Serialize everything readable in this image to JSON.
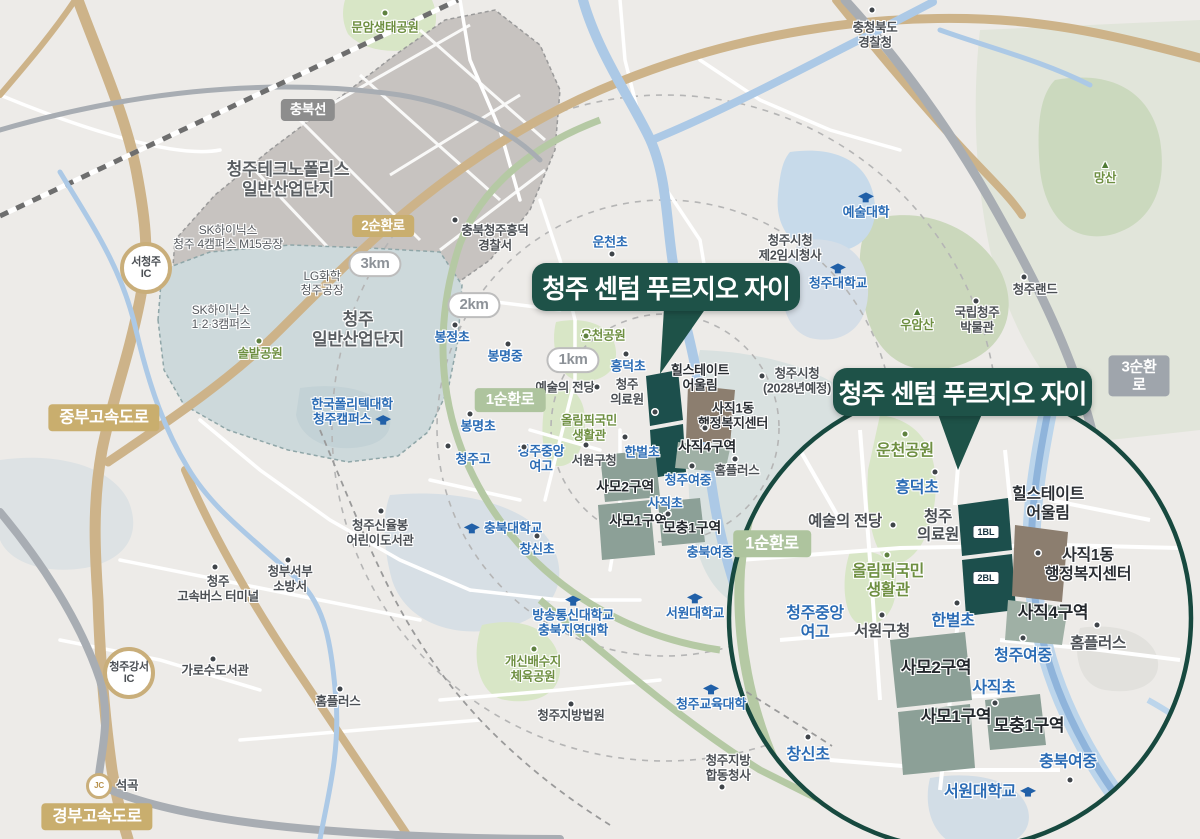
{
  "title": "청주 센텀 푸르지오 자이",
  "colors": {
    "accent_teal": "#1E5248",
    "site_teal": "#1C4F4C",
    "hillstate_brown": "#8C7E6F",
    "district_sage": "#8CA097",
    "school_blue": "#2B6CB5",
    "park_green": "#6E8F41",
    "highway_tan": "#C9AE6E",
    "ring_road_green": "#AEC49E",
    "expressway_gray": "#9FA5AC",
    "river_blue": "#ACC9E6"
  },
  "inset": {
    "bl1": "1BL",
    "bl2": "2BL",
    "labels": [
      {
        "t": "운천공원",
        "x": 905,
        "y": 452,
        "c": "lb-park-lg"
      },
      {
        "t": "흥덕초",
        "x": 917,
        "y": 489,
        "c": "lb-school-lg"
      },
      {
        "t": "예술의 전당",
        "x": 845,
        "y": 522,
        "c": "lb-place-ins"
      },
      {
        "t": "청주\n의료원",
        "x": 938,
        "y": 527,
        "c": "lb-place-ins"
      },
      {
        "t": "힐스테이트\n어울림",
        "x": 1048,
        "y": 505,
        "c": "lb-dark-lg"
      },
      {
        "t": "사직1동\n행정복지센터",
        "x": 1088,
        "y": 566,
        "c": "lb-dark-lg"
      },
      {
        "t": "1순환로",
        "x": 772,
        "y": 544,
        "c": "badge-green-lg",
        "n": "road-badge-1st-ring-inset"
      },
      {
        "t": "올림픽국민\n생활관",
        "x": 888,
        "y": 582,
        "c": "lb-park-lg"
      },
      {
        "t": "청주중앙\n여고",
        "x": 815,
        "y": 624,
        "c": "lb-school-lg"
      },
      {
        "t": "서원구청",
        "x": 882,
        "y": 632,
        "c": "lb-place-ins"
      },
      {
        "t": "한벌초",
        "x": 953,
        "y": 622,
        "c": "lb-school-lg"
      },
      {
        "t": "사직4구역",
        "x": 1053,
        "y": 613,
        "c": "lb-district-lg"
      },
      {
        "t": "홈플러스",
        "x": 1098,
        "y": 644,
        "c": "lb-place-ins"
      },
      {
        "t": "사모2구역",
        "x": 936,
        "y": 668,
        "c": "lb-district-lg"
      },
      {
        "t": "청주여중",
        "x": 1023,
        "y": 657,
        "c": "lb-school-lg"
      },
      {
        "t": "사직초",
        "x": 994,
        "y": 689,
        "c": "lb-school-lg"
      },
      {
        "t": "사모1구역",
        "x": 956,
        "y": 717,
        "c": "lb-district-lg"
      },
      {
        "t": "모충1구역",
        "x": 1029,
        "y": 726,
        "c": "lb-district-lg"
      },
      {
        "t": "창신초",
        "x": 808,
        "y": 756,
        "c": "lb-school-lg"
      },
      {
        "t": "충북여중",
        "x": 1068,
        "y": 763,
        "c": "lb-school-lg"
      },
      {
        "t": "서원대학교",
        "x": 990,
        "y": 793,
        "c": "lb-school-lg",
        "i": "cap",
        "ip": "right"
      }
    ],
    "dots": [
      {
        "x": 905,
        "y": 434,
        "c": "g"
      },
      {
        "x": 935,
        "y": 472
      },
      {
        "x": 893,
        "y": 525
      },
      {
        "x": 887,
        "y": 555,
        "c": "g"
      },
      {
        "x": 882,
        "y": 615
      },
      {
        "x": 957,
        "y": 603
      },
      {
        "x": 1038,
        "y": 553
      },
      {
        "x": 1097,
        "y": 625
      },
      {
        "x": 1023,
        "y": 638
      },
      {
        "x": 995,
        "y": 703
      },
      {
        "x": 808,
        "y": 737
      },
      {
        "x": 1070,
        "y": 780
      }
    ]
  },
  "main_map": {
    "labels": [
      {
        "t": "문암생태공원",
        "x": 385,
        "y": 28,
        "c": "lb-park"
      },
      {
        "t": "충북선",
        "x": 308,
        "y": 110,
        "c": "badge-rail",
        "n": "railway-badge-chungbuk-line"
      },
      {
        "t": "청주테크노폴리스\n일반산업단지",
        "x": 288,
        "y": 180,
        "c": "lb-place-lg"
      },
      {
        "t": "SK하이닉스\n청주 4캠퍼스 M15공장",
        "x": 228,
        "y": 237,
        "c": "lb-place-sm"
      },
      {
        "t": "서청주\nIC",
        "x": 146,
        "y": 268,
        "c": "ic-circle",
        "n": "ic-badge-seocheongju"
      },
      {
        "t": "2순환로",
        "x": 383,
        "y": 226,
        "c": "badge-tan",
        "n": "road-badge-2nd-ring"
      },
      {
        "t": "3km",
        "x": 375,
        "y": 264,
        "c": "pill",
        "n": "radius-pill-3km"
      },
      {
        "t": "LG화학\n청주공장",
        "x": 322,
        "y": 283,
        "c": "lb-place-sm"
      },
      {
        "t": "SK하이닉스\n1·2·3캠퍼스",
        "x": 221,
        "y": 317,
        "c": "lb-place-sm"
      },
      {
        "t": "청주\n일반산업단지",
        "x": 358,
        "y": 330,
        "c": "lb-place-lg"
      },
      {
        "t": "솔밭공원",
        "x": 260,
        "y": 354,
        "c": "lb-park"
      },
      {
        "t": "충북청주흥덕\n경찰서",
        "x": 495,
        "y": 238,
        "c": "lb-place"
      },
      {
        "t": "운천초",
        "x": 610,
        "y": 242,
        "c": "lb-school"
      },
      {
        "t": "충청북도\n경찰청",
        "x": 875,
        "y": 35,
        "c": "lb-place"
      },
      {
        "t": "예술대학",
        "x": 866,
        "y": 206,
        "c": "lb-school",
        "i": "cap",
        "ip": "above"
      },
      {
        "t": "청주시청\n제2임시청사",
        "x": 790,
        "y": 248,
        "c": "lb-place"
      },
      {
        "t": "청주대학교",
        "x": 838,
        "y": 277,
        "c": "lb-school",
        "i": "cap",
        "ip": "above"
      },
      {
        "t": "망산",
        "x": 1105,
        "y": 173,
        "c": "lb-park",
        "i": "mtn",
        "ip": "above"
      },
      {
        "t": "우암산",
        "x": 917,
        "y": 320,
        "c": "lb-park",
        "i": "mtn",
        "ip": "above"
      },
      {
        "t": "국립청주\n박물관",
        "x": 977,
        "y": 320,
        "c": "lb-place"
      },
      {
        "t": "청주랜드",
        "x": 1035,
        "y": 290,
        "c": "lb-place"
      },
      {
        "t": "3순환로",
        "x": 1139,
        "y": 376,
        "c": "badge-gray",
        "n": "road-badge-3rd-ring"
      },
      {
        "t": "2km",
        "x": 474,
        "y": 305,
        "c": "pill",
        "n": "radius-pill-2km"
      },
      {
        "t": "1km",
        "x": 573,
        "y": 360,
        "c": "pill",
        "n": "radius-pill-1km"
      },
      {
        "t": "운천공원",
        "x": 603,
        "y": 336,
        "c": "lb-park"
      },
      {
        "t": "흥덕초",
        "x": 628,
        "y": 366,
        "c": "lb-school"
      },
      {
        "t": "봉정초",
        "x": 452,
        "y": 337,
        "c": "lb-school"
      },
      {
        "t": "봉명중",
        "x": 505,
        "y": 356,
        "c": "lb-school"
      },
      {
        "t": "예술의 전당",
        "x": 565,
        "y": 388,
        "c": "lb-place"
      },
      {
        "t": "청주\n의료원",
        "x": 627,
        "y": 392,
        "c": "lb-place"
      },
      {
        "t": "힐스테이트\n어울림",
        "x": 700,
        "y": 378,
        "c": "lb-dark"
      },
      {
        "t": "사직1동\n행정복지센터",
        "x": 733,
        "y": 416,
        "c": "lb-dark"
      },
      {
        "t": "청주시청\n(2028년예정)",
        "x": 797,
        "y": 381,
        "c": "lb-place"
      },
      {
        "t": "1순환로",
        "x": 510,
        "y": 400,
        "c": "badge-green",
        "n": "road-badge-1st-ring"
      },
      {
        "t": "올림픽국민\n생활관",
        "x": 589,
        "y": 428,
        "c": "lb-park"
      },
      {
        "t": "봉명초",
        "x": 478,
        "y": 426,
        "c": "lb-school"
      },
      {
        "t": "청주고",
        "x": 473,
        "y": 459,
        "c": "lb-school"
      },
      {
        "t": "청주중앙\n여고",
        "x": 541,
        "y": 459,
        "c": "lb-school"
      },
      {
        "t": "서원구청",
        "x": 594,
        "y": 461,
        "c": "lb-place"
      },
      {
        "t": "한벌초",
        "x": 642,
        "y": 452,
        "c": "lb-school"
      },
      {
        "t": "사직4구역",
        "x": 707,
        "y": 447,
        "c": "lb-district"
      },
      {
        "t": "사모2구역",
        "x": 625,
        "y": 487,
        "c": "lb-district"
      },
      {
        "t": "청주여중",
        "x": 688,
        "y": 480,
        "c": "lb-school"
      },
      {
        "t": "홈플러스",
        "x": 737,
        "y": 471,
        "c": "lb-place"
      },
      {
        "t": "사직초",
        "x": 665,
        "y": 503,
        "c": "lb-school"
      },
      {
        "t": "사모1구역",
        "x": 638,
        "y": 521,
        "c": "lb-district"
      },
      {
        "t": "모충1구역",
        "x": 692,
        "y": 528,
        "c": "lb-district"
      },
      {
        "t": "충북대학교",
        "x": 503,
        "y": 528,
        "c": "lb-school",
        "i": "cap",
        "ip": "left"
      },
      {
        "t": "창신초",
        "x": 537,
        "y": 549,
        "c": "lb-school"
      },
      {
        "t": "한국폴리텍대학\n청주캠퍼스",
        "x": 352,
        "y": 412,
        "c": "lb-school",
        "i": "cap",
        "ip": "right"
      },
      {
        "t": "청주신율봉\n어린이도서관",
        "x": 380,
        "y": 533,
        "c": "lb-place"
      },
      {
        "t": "충북여중",
        "x": 710,
        "y": 552,
        "c": "lb-school"
      },
      {
        "t": "서원대학교",
        "x": 695,
        "y": 607,
        "c": "lb-school",
        "i": "cap",
        "ip": "above"
      },
      {
        "t": "방송통신대학교\n충북지역대학",
        "x": 573,
        "y": 617,
        "c": "lb-school",
        "i": "cap",
        "ip": "above"
      },
      {
        "t": "청주\n고속버스 터미널",
        "x": 218,
        "y": 589,
        "c": "lb-place"
      },
      {
        "t": "청부서부\n소방서",
        "x": 290,
        "y": 579,
        "c": "lb-place"
      },
      {
        "t": "가로수도서관",
        "x": 215,
        "y": 671,
        "c": "lb-place"
      },
      {
        "t": "홈플러스",
        "x": 338,
        "y": 702,
        "c": "lb-place"
      },
      {
        "t": "청주강서\nIC",
        "x": 129,
        "y": 673,
        "c": "ic-circle",
        "n": "ic-badge-cheongju-gangseo"
      },
      {
        "t": "JC",
        "x": 99,
        "y": 786,
        "c": "jc-circle",
        "n": "jc-badge-seokgok"
      },
      {
        "t": "석곡",
        "x": 127,
        "y": 786,
        "c": "lb-place"
      },
      {
        "t": "경부고속도로",
        "x": 97,
        "y": 817,
        "c": "badge-tan-lg",
        "n": "road-badge-gyeongbu-expressway"
      },
      {
        "t": "중부고속도로",
        "x": 104,
        "y": 418,
        "c": "badge-tan-lg",
        "n": "road-badge-jungbu-expressway"
      },
      {
        "t": "개신배수지\n체육공원",
        "x": 533,
        "y": 669,
        "c": "lb-park"
      },
      {
        "t": "청주지방법원",
        "x": 571,
        "y": 716,
        "c": "lb-place"
      },
      {
        "t": "청주교육대학",
        "x": 711,
        "y": 698,
        "c": "lb-school",
        "i": "cap",
        "ip": "above"
      },
      {
        "t": "청주지방\n합동청사",
        "x": 728,
        "y": 768,
        "c": "lb-place"
      }
    ],
    "dots": [
      {
        "x": 385,
        "y": 13,
        "c": "g"
      },
      {
        "x": 872,
        "y": 10
      },
      {
        "x": 455,
        "y": 220
      },
      {
        "x": 612,
        "y": 254
      },
      {
        "x": 762,
        "y": 376
      },
      {
        "x": 976,
        "y": 301
      },
      {
        "x": 1024,
        "y": 277
      },
      {
        "x": 586,
        "y": 336,
        "c": "g"
      },
      {
        "x": 626,
        "y": 354
      },
      {
        "x": 597,
        "y": 387
      },
      {
        "x": 655,
        "y": 412
      },
      {
        "x": 455,
        "y": 325
      },
      {
        "x": 508,
        "y": 344
      },
      {
        "x": 470,
        "y": 414
      },
      {
        "x": 448,
        "y": 446
      },
      {
        "x": 524,
        "y": 447
      },
      {
        "x": 586,
        "y": 445
      },
      {
        "x": 625,
        "y": 437
      },
      {
        "x": 735,
        "y": 459
      },
      {
        "x": 668,
        "y": 514
      },
      {
        "x": 537,
        "y": 536
      },
      {
        "x": 381,
        "y": 511
      },
      {
        "x": 215,
        "y": 567
      },
      {
        "x": 288,
        "y": 560
      },
      {
        "x": 213,
        "y": 659
      },
      {
        "x": 340,
        "y": 689
      },
      {
        "x": 534,
        "y": 649,
        "c": "g"
      },
      {
        "x": 571,
        "y": 704
      },
      {
        "x": 722,
        "y": 787
      },
      {
        "x": 259,
        "y": 341,
        "c": "g"
      },
      {
        "x": 705,
        "y": 428
      },
      {
        "x": 692,
        "y": 466
      }
    ]
  }
}
